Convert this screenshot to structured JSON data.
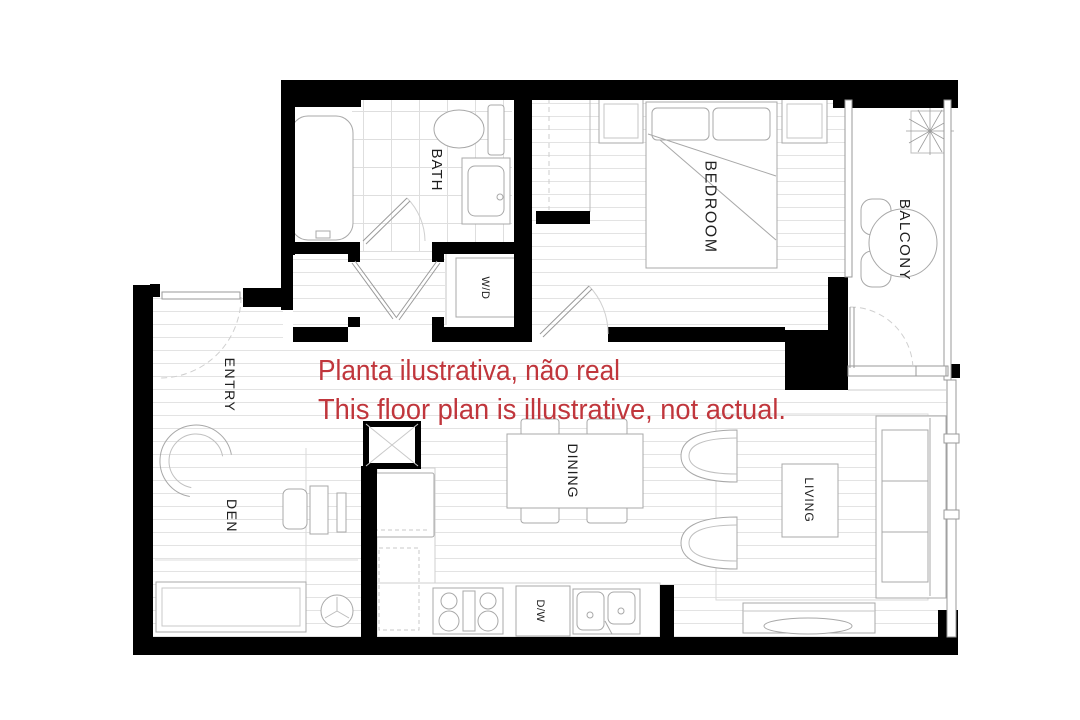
{
  "title": "Apartment floor plan",
  "annotation": {
    "line1": "Planta ilustrativa, não real",
    "line2": "This floor plan is illustrative, not actual.",
    "color": "#c0363c"
  },
  "rooms": {
    "bath": "BATH",
    "washer_dryer": "W/D",
    "bedroom": "BEDROOM",
    "balcony": "BALCONY",
    "entry": "ENTRY",
    "den": "DEN",
    "dining": "DINING",
    "dishwasher": "D/W",
    "living": "LIVING"
  },
  "colors": {
    "wall": "#000000",
    "furniture_line": "#a8a8a8",
    "floor_line": "#e3e3e3",
    "label": "#1f1f1f",
    "background": "#ffffff"
  }
}
